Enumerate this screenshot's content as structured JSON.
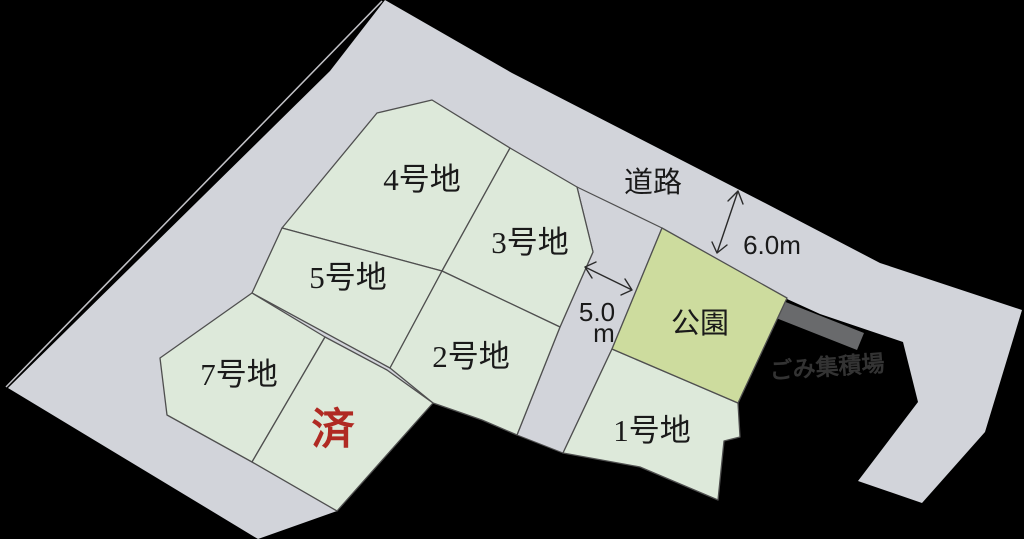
{
  "colors": {
    "background": "#000000",
    "road": "#d2d4da",
    "lot": "#dde9da",
    "park": "#cddc9e",
    "garbage_strip": "#696a6c",
    "border": "#4f4f4f",
    "text": "#1a1a1a",
    "sold_red": "#b02a23",
    "gomi_text": "#333333"
  },
  "labels": {
    "road": "道路",
    "park": "公園",
    "garbage": "ごみ集積場",
    "sold": "済"
  },
  "lots": [
    {
      "id": "1",
      "label": "1号地"
    },
    {
      "id": "2",
      "label": "2号地"
    },
    {
      "id": "3",
      "label": "3号地"
    },
    {
      "id": "4",
      "label": "4号地"
    },
    {
      "id": "5",
      "label": "5号地"
    },
    {
      "id": "7",
      "label": "7号地"
    }
  ],
  "dimensions": {
    "road_top_width": "6.0m",
    "road_side_width_value": "5.0",
    "road_side_width_unit": "m"
  }
}
